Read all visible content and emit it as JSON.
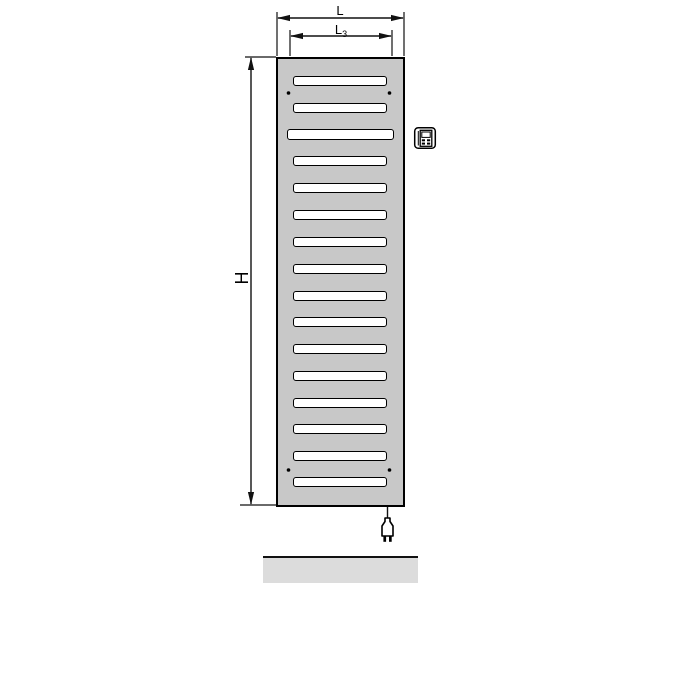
{
  "labels": {
    "overall_width": "L",
    "inner_width_base": "L",
    "inner_width_sub": "3",
    "height": "H"
  },
  "colors": {
    "background": "#ffffff",
    "line": "#111111",
    "radiator_fill": "#c8c8c8",
    "slat_fill": "#ffffff",
    "slat_border": "#000000",
    "floor_fill": "#dcdcdc"
  },
  "radiator": {
    "slat_count": 16,
    "wide_slat_index": 2,
    "slats": [
      {
        "top": 16.5,
        "wide": false
      },
      {
        "top": 43.5,
        "wide": false
      },
      {
        "top": 69.5,
        "wide": true
      },
      {
        "top": 96.5,
        "wide": false
      },
      {
        "top": 123.5,
        "wide": false
      },
      {
        "top": 150.5,
        "wide": false
      },
      {
        "top": 177.5,
        "wide": false
      },
      {
        "top": 204.5,
        "wide": false
      },
      {
        "top": 231.5,
        "wide": false
      },
      {
        "top": 257.5,
        "wide": false
      },
      {
        "top": 284.5,
        "wide": false
      },
      {
        "top": 311.5,
        "wide": false
      },
      {
        "top": 338.5,
        "wide": false
      },
      {
        "top": 364.5,
        "wide": false
      },
      {
        "top": 391.5,
        "wide": false
      },
      {
        "top": 417.5,
        "wide": false
      }
    ],
    "screw_dot_count": 4
  },
  "icons": {
    "control_unit": "control-unit-icon",
    "power_plug": "power-plug-icon"
  }
}
